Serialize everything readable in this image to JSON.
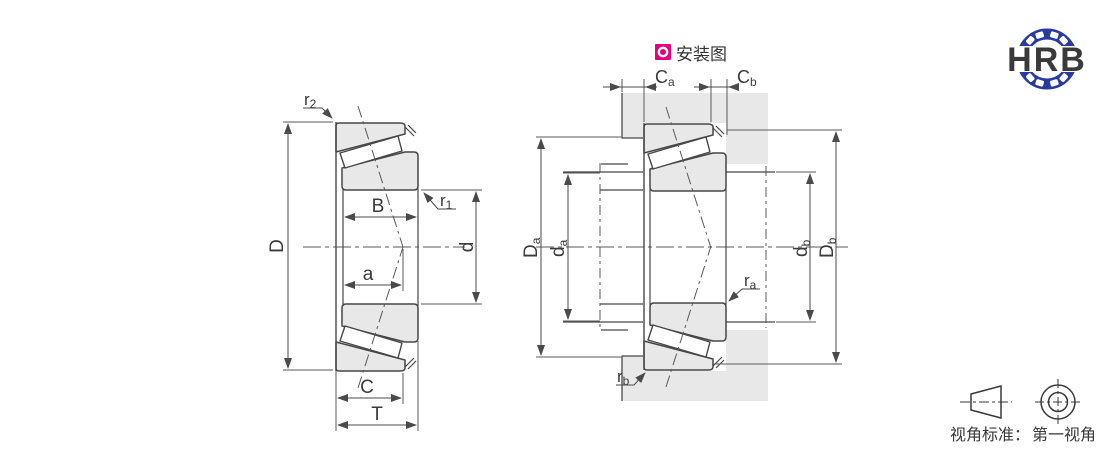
{
  "drawing_title": "tapered-roller-bearing-dimension-and-mounting-diagram",
  "logo": {
    "text": "HRB",
    "color": "#2b3aa0"
  },
  "install_badge": {
    "label": "安装图",
    "badge_color": "#e5007f"
  },
  "view_note": {
    "label": "视角标准：",
    "value": "第一视角"
  },
  "left_view": {
    "dims": {
      "D": "D",
      "B": "B",
      "d": "d",
      "a": "a",
      "C": "C",
      "T": "T",
      "r1": {
        "main": "r",
        "sub": "1"
      },
      "r2": {
        "main": "r",
        "sub": "2"
      }
    }
  },
  "right_view": {
    "dims": {
      "Ca": {
        "main": "C",
        "sub": "a"
      },
      "Cb": {
        "main": "C",
        "sub": "b"
      },
      "Da": {
        "main": "D",
        "sub": "a"
      },
      "da": {
        "main": "d",
        "sub": "a"
      },
      "db": {
        "main": "d",
        "sub": "b"
      },
      "Db": {
        "main": "D",
        "sub": "b"
      },
      "ra": {
        "main": "r",
        "sub": "a"
      },
      "rb": {
        "main": "r",
        "sub": "b"
      }
    }
  },
  "colors": {
    "outline": "#474747",
    "dimension_line": "#5a5a5a",
    "part_fill": "#e8e8e8",
    "text": "#3a3a3a",
    "badge_magenta": "#e5007f",
    "logo_blue": "#2b3aa0"
  }
}
